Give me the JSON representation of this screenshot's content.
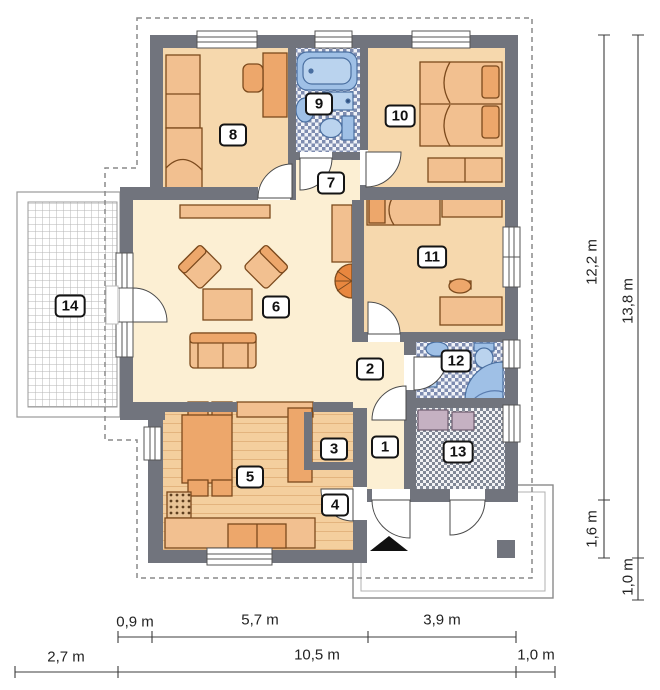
{
  "plan": {
    "type": "single-storey house floor plan",
    "entrance_marker": "black triangle arrow at main door"
  },
  "rooms": [
    "1",
    "2",
    "3",
    "4",
    "5",
    "6",
    "7",
    "8",
    "9",
    "10",
    "11",
    "12",
    "13",
    "14"
  ],
  "dims": {
    "right": [
      "12,2 m",
      "13,8 m",
      "1,6 m",
      "1,0 m"
    ],
    "bottom": [
      "0,9 m",
      "5,7 m",
      "3,9 m",
      "2,7 m",
      "10,5 m",
      "1,0 m"
    ]
  },
  "colors": {
    "wall": "#71747d",
    "floor_bedroom": "#f6d8ad",
    "floor_hall": "#fcefd3",
    "furniture": "#eda76b",
    "furniture_light": "#f2c090",
    "fixture_blue": "#9fc0e6",
    "fireplace": "#e8873f",
    "appliance_gray": "#c5b1c2",
    "dashed_roof": "#8a8a8a",
    "dimension": "#3c3c3c"
  }
}
